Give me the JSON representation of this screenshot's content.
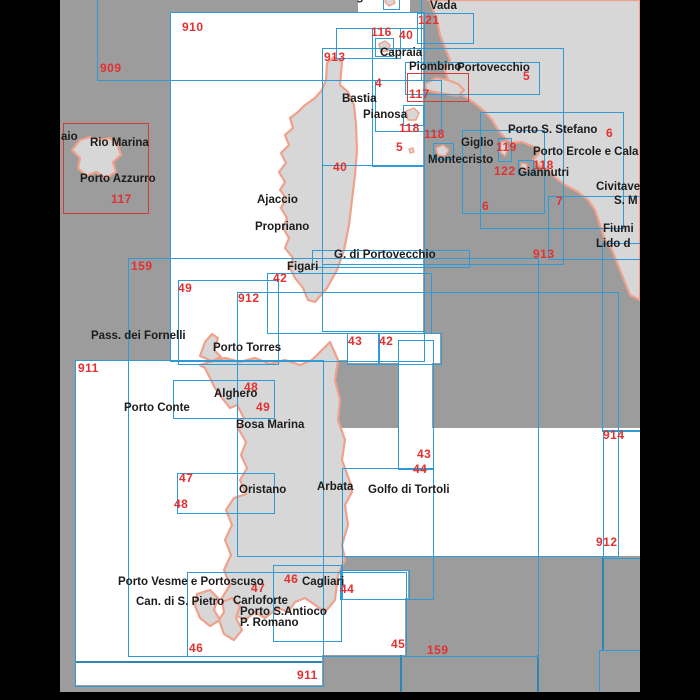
{
  "title": "Chart index map - Corsica, Sardinia and Tuscan Archipelago",
  "colors": {
    "sea": "#9c9c9c",
    "chart_fill": "#ffffff",
    "chart_outline_blue": "#2f9bd6",
    "chart_outline_red": "#d23c34",
    "land_fill": "#d7d7d7",
    "coastline": "#f0a18c",
    "number_red": "#e33030",
    "placename_black": "#1c1c1c",
    "frame_black": "#000000"
  },
  "map": {
    "sea": {
      "x": 60,
      "y": 0,
      "w": 580,
      "h": 692
    },
    "bars": [
      {
        "id": "left-frame-bar",
        "x": 0,
        "y": 0,
        "w": 60,
        "h": 700
      },
      {
        "id": "right-frame-bar",
        "x": 640,
        "y": 0,
        "w": 60,
        "h": 700
      },
      {
        "id": "bottom-frame-bar",
        "x": 60,
        "y": 692,
        "w": 580,
        "h": 8
      }
    ],
    "white_boxes": [
      {
        "id": "chart-area-910",
        "x": 170,
        "y": 12,
        "w": 253,
        "h": 348
      },
      {
        "id": "chart-area-911",
        "x": 75,
        "y": 360,
        "w": 247,
        "h": 325
      },
      {
        "id": "chart-area-top-strip",
        "x": 358,
        "y": 0,
        "w": 52,
        "h": 14
      },
      {
        "id": "chart-area-46-carloforte",
        "x": 187,
        "y": 572,
        "w": 218,
        "h": 83
      },
      {
        "id": "chart-area-46-cagliari",
        "x": 273,
        "y": 565,
        "w": 67,
        "h": 75
      },
      {
        "id": "chart-area-44-cagliari",
        "x": 340,
        "y": 570,
        "w": 68,
        "h": 28
      },
      {
        "id": "chart-area-912-east",
        "x": 342,
        "y": 428,
        "w": 298,
        "h": 128
      },
      {
        "id": "chart-area-bonifacio",
        "x": 347,
        "y": 333,
        "w": 93,
        "h": 30
      },
      {
        "id": "chart-area-east-notch",
        "x": 398,
        "y": 363,
        "w": 34,
        "h": 65
      }
    ],
    "patches": [
      {
        "id": "sea-gap-portovecchio",
        "x": 423,
        "y": 266,
        "w": 39,
        "h": 26
      },
      {
        "id": "sea-gap-south-sardinia",
        "x": 322,
        "y": 555,
        "w": 18,
        "h": 14
      }
    ],
    "outline_boxes": [
      {
        "id": "chart-909",
        "x": 97,
        "y": -10,
        "w": 323,
        "h": 89
      },
      {
        "id": "chart-910",
        "x": 170,
        "y": 12,
        "w": 253,
        "h": 348
      },
      {
        "id": "chart-121",
        "x": 417,
        "y": 13,
        "w": 55,
        "h": 29
      },
      {
        "id": "chart-gorgona",
        "x": 383,
        "y": -6,
        "w": 15,
        "h": 14
      },
      {
        "id": "chart-116",
        "x": 336,
        "y": 28,
        "w": 63,
        "h": 29
      },
      {
        "id": "chart-40-north",
        "x": 372,
        "y": 28,
        "w": 51,
        "h": 137
      },
      {
        "id": "chart-capraia",
        "x": 375,
        "y": 38,
        "w": 17,
        "h": 17
      },
      {
        "id": "chart-4",
        "x": 375,
        "y": 80,
        "w": 65,
        "h": 50
      },
      {
        "id": "chart-piombino-portovecchio",
        "x": 405,
        "y": 62,
        "w": 133,
        "h": 31
      },
      {
        "id": "chart-pianosa",
        "x": 403,
        "y": 105,
        "w": 19,
        "h": 19
      },
      {
        "id": "chart-913",
        "x": 322,
        "y": 48,
        "w": 240,
        "h": 215
      },
      {
        "id": "chart-montecristo",
        "x": 433,
        "y": 143,
        "w": 19,
        "h": 15
      },
      {
        "id": "chart-40-south",
        "x": 322,
        "y": 165,
        "w": 101,
        "h": 165
      },
      {
        "id": "chart-g-di-portovecchio",
        "x": 312,
        "y": 250,
        "w": 156,
        "h": 16
      },
      {
        "id": "chart-42-figari",
        "x": 267,
        "y": 273,
        "w": 163,
        "h": 59
      },
      {
        "id": "chart-159",
        "x": 128,
        "y": 258,
        "w": 409,
        "h": 397
      },
      {
        "id": "chart-49",
        "x": 178,
        "y": 280,
        "w": 99,
        "h": 83
      },
      {
        "id": "chart-912",
        "x": 237,
        "y": 292,
        "w": 380,
        "h": 263
      },
      {
        "id": "chart-43-bonifacio",
        "x": 347,
        "y": 333,
        "w": 31,
        "h": 30
      },
      {
        "id": "chart-42-bonifacio",
        "x": 378,
        "y": 333,
        "w": 62,
        "h": 30
      },
      {
        "id": "chart-911",
        "x": 75,
        "y": 360,
        "w": 247,
        "h": 325
      },
      {
        "id": "chart-48-alghero",
        "x": 173,
        "y": 380,
        "w": 100,
        "h": 37
      },
      {
        "id": "chart-47-48-oristano",
        "x": 177,
        "y": 473,
        "w": 96,
        "h": 39
      },
      {
        "id": "chart-43-east",
        "x": 398,
        "y": 340,
        "w": 34,
        "h": 128
      },
      {
        "id": "chart-44-east",
        "x": 342,
        "y": 468,
        "w": 90,
        "h": 130
      },
      {
        "id": "chart-46-carloforte",
        "x": 187,
        "y": 572,
        "w": 218,
        "h": 83
      },
      {
        "id": "chart-46-cagliari",
        "x": 273,
        "y": 565,
        "w": 67,
        "h": 75
      },
      {
        "id": "chart-44-cagliari",
        "x": 340,
        "y": 570,
        "w": 68,
        "h": 28
      },
      {
        "id": "chart-6-argentario",
        "x": 480,
        "y": 112,
        "w": 142,
        "h": 115
      },
      {
        "id": "chart-119-giglio",
        "x": 498,
        "y": 138,
        "w": 12,
        "h": 22
      },
      {
        "id": "chart-122",
        "x": 462,
        "y": 130,
        "w": 81,
        "h": 82
      },
      {
        "id": "chart-118-giannutri",
        "x": 518,
        "y": 160,
        "w": 14,
        "h": 13
      },
      {
        "id": "chart-7",
        "x": 548,
        "y": 196,
        "w": 92,
        "h": 62
      },
      {
        "id": "chart-fiumicino",
        "x": 602,
        "y": 243,
        "w": 38,
        "h": 187
      },
      {
        "id": "chart-914",
        "x": 603,
        "y": 430,
        "w": 37,
        "h": 127
      },
      {
        "id": "chart-bottom-right",
        "x": 599,
        "y": 650,
        "w": 41,
        "h": 42
      }
    ],
    "red_boxes": [
      {
        "id": "chart-117-elba",
        "x": 63,
        "y": 123,
        "w": 84,
        "h": 89
      },
      {
        "id": "chart-117-piombino",
        "x": 407,
        "y": 73,
        "w": 60,
        "h": 27
      }
    ],
    "segments": [
      {
        "id": "grid-line-v1",
        "x": 400,
        "y": 655,
        "w": 2,
        "h": 37
      },
      {
        "id": "grid-line-v2",
        "x": 537,
        "y": 655,
        "w": 2,
        "h": 37
      },
      {
        "id": "grid-line-v3",
        "x": 602,
        "y": 557,
        "w": 2,
        "h": 93
      },
      {
        "id": "grid-line-h1",
        "x": 75,
        "y": 661,
        "w": 247,
        "h": 2
      }
    ],
    "land": [
      {
        "id": "corsica",
        "d": "M334,57 L342,62 L340,85 L348,92 L354,105 L356,125 L357,150 L355,175 L352,200 L349,225 L344,250 L337,270 L327,288 L315,302 L308,300 L303,288 L295,278 L290,268 L293,258 L285,248 L289,238 L283,228 L287,218 L281,208 L286,198 L280,190 L285,182 L279,172 L286,163 L281,153 L289,145 L285,135 L293,128 L290,118 L298,112 L305,105 L315,98 L322,90 L326,80 L327,63 Z"
      },
      {
        "id": "sardinia",
        "d": "M330,342 L338,360 L335,380 L340,400 L338,420 L345,440 L342,460 L350,482 L352,492 L345,505 L348,525 L342,545 L345,560 L338,575 L335,600 L325,612 L315,605 L305,598 L295,602 L288,612 L278,608 L265,618 L255,612 L245,620 L235,615 L228,622 L222,598 L230,585 L224,570 L231,555 L225,540 L232,525 L226,510 L234,498 L246,494 L240,480 L247,468 L241,455 L246,442 L239,430 L244,418 L237,405 L230,408 L222,398 L215,388 L210,378 L205,368 L200,365 L210,362 L225,358 L240,362 L255,358 L270,364 L285,360 L300,365 L312,360 L322,350 Z"
      },
      {
        "id": "italian-mainland",
        "d": "M428,0 L640,0 L640,300 L630,295 L620,270 L612,250 L605,240 L600,225 L595,210 L588,200 L578,192 L565,185 L556,178 L548,170 L540,166 L533,160 L540,152 L532,146 L522,142 L512,143 L505,138 L498,130 L492,120 L485,112 L478,106 L470,100 L462,95 L455,88 L448,80 L445,70 L450,60 L445,48 L440,35 L437,20 L433,10 L430,0 Z"
      },
      {
        "id": "piombino-promontory",
        "d": "M425,84 L436,78 L448,80 L458,84 L464,90 L458,96 L446,94 L434,92 L426,90 Z"
      },
      {
        "id": "elba",
        "d": "M72,150 L80,140 L90,137 L100,140 L110,138 L118,146 L121,155 L113,162 L116,172 L106,178 L96,172 L86,176 L78,168 L80,158 Z"
      },
      {
        "id": "asinara",
        "d": "M200,356 L205,342 L212,334 L218,338 L214,350 L221,357 L212,361 Z"
      },
      {
        "id": "san-pietro",
        "d": "M197,594 L210,590 L218,598 L214,610 L220,620 L210,626 L200,618 L195,606 Z"
      },
      {
        "id": "sant-antioco",
        "d": "M222,602 L232,598 L240,606 L236,618 L242,630 L234,640 L224,634 L219,620 L224,612 Z"
      }
    ],
    "islets": [
      {
        "id": "capraia-islet",
        "d": "M379,44 L385,41 L390,45 L388,51 L381,52 Z"
      },
      {
        "id": "gorgona-islet",
        "d": "M386,-2 L393,-3 L395,3 L389,6 L385,2 Z"
      },
      {
        "id": "pianosa-islet",
        "d": "M406,111 L414,108 L419,113 L416,120 L408,120 Z"
      },
      {
        "id": "montecristo-islet",
        "d": "M436,148 L443,145 L449,150 L445,156 L438,155 Z"
      },
      {
        "id": "giglio-islet",
        "d": "M501,142 L506,141 L508,149 L505,156 L500,152 Z"
      },
      {
        "id": "giannutri-islet",
        "d": "M521,163 L527,164 L526,171 L521,169 Z"
      },
      {
        "id": "scoglio-islet",
        "d": "M409,149 L413,148 L414,152 L410,153 Z"
      }
    ],
    "labels_red": [
      {
        "text": "909",
        "x": 100,
        "y": 62
      },
      {
        "text": "910",
        "x": 182,
        "y": 21
      },
      {
        "text": "913",
        "x": 324,
        "y": 51
      },
      {
        "text": "116",
        "x": 371,
        "y": 26
      },
      {
        "text": "40",
        "x": 399,
        "y": 29
      },
      {
        "text": "121",
        "x": 418,
        "y": 14
      },
      {
        "text": "4",
        "x": 375,
        "y": 77
      },
      {
        "text": "117",
        "x": 409,
        "y": 88
      },
      {
        "text": "118",
        "x": 399,
        "y": 122
      },
      {
        "text": "5",
        "x": 396,
        "y": 141
      },
      {
        "text": "118",
        "x": 424,
        "y": 128
      },
      {
        "text": "5",
        "x": 523,
        "y": 70
      },
      {
        "text": "119",
        "x": 496,
        "y": 141
      },
      {
        "text": "118",
        "x": 533,
        "y": 159
      },
      {
        "text": "122",
        "x": 494,
        "y": 165
      },
      {
        "text": "6",
        "x": 606,
        "y": 127
      },
      {
        "text": "6",
        "x": 482,
        "y": 200
      },
      {
        "text": "7",
        "x": 556,
        "y": 195
      },
      {
        "text": "913",
        "x": 533,
        "y": 248
      },
      {
        "text": "117",
        "x": 111,
        "y": 193
      },
      {
        "text": "159",
        "x": 131,
        "y": 260
      },
      {
        "text": "49",
        "x": 178,
        "y": 282
      },
      {
        "text": "42",
        "x": 273,
        "y": 272
      },
      {
        "text": "912",
        "x": 238,
        "y": 292
      },
      {
        "text": "40",
        "x": 333,
        "y": 161
      },
      {
        "text": "43",
        "x": 348,
        "y": 335
      },
      {
        "text": "42",
        "x": 379,
        "y": 335
      },
      {
        "text": "911",
        "x": 78,
        "y": 362
      },
      {
        "text": "48",
        "x": 244,
        "y": 381
      },
      {
        "text": "49",
        "x": 256,
        "y": 401
      },
      {
        "text": "914",
        "x": 603,
        "y": 429
      },
      {
        "text": "43",
        "x": 417,
        "y": 448
      },
      {
        "text": "44",
        "x": 413,
        "y": 463
      },
      {
        "text": "47",
        "x": 179,
        "y": 472
      },
      {
        "text": "48",
        "x": 174,
        "y": 498
      },
      {
        "text": "912",
        "x": 596,
        "y": 536
      },
      {
        "text": "46",
        "x": 284,
        "y": 573
      },
      {
        "text": "47",
        "x": 251,
        "y": 582
      },
      {
        "text": "44",
        "x": 340,
        "y": 583
      },
      {
        "text": "46",
        "x": 189,
        "y": 642
      },
      {
        "text": "45",
        "x": 391,
        "y": 638
      },
      {
        "text": "159",
        "x": 427,
        "y": 644
      },
      {
        "text": "911",
        "x": 297,
        "y": 669
      }
    ],
    "labels_place": [
      {
        "text": "Gorgona",
        "x": 336,
        "y": -8
      },
      {
        "text": "Vada",
        "x": 430,
        "y": 1
      },
      {
        "text": "Capraia",
        "x": 380,
        "y": 48
      },
      {
        "text": "Piombino",
        "x": 409,
        "y": 62
      },
      {
        "text": "Portovecchio",
        "x": 457,
        "y": 63
      },
      {
        "text": "Bastia",
        "x": 342,
        "y": 94
      },
      {
        "text": "Pianosa",
        "x": 363,
        "y": 110
      },
      {
        "text": "aio",
        "x": 61,
        "y": 132
      },
      {
        "text": "Rio Marina",
        "x": 90,
        "y": 138
      },
      {
        "text": "Porto Azzurro",
        "x": 80,
        "y": 174
      },
      {
        "text": "Porto S. Stefano",
        "x": 508,
        "y": 125
      },
      {
        "text": "Giglio",
        "x": 461,
        "y": 138
      },
      {
        "text": "Porto Ercole e Cala G",
        "x": 533,
        "y": 147
      },
      {
        "text": "Montecristo",
        "x": 428,
        "y": 155
      },
      {
        "text": "Giannutri",
        "x": 518,
        "y": 168
      },
      {
        "text": "Civitave",
        "x": 596,
        "y": 182
      },
      {
        "text": "S. M",
        "x": 614,
        "y": 196
      },
      {
        "text": "Fiumi",
        "x": 603,
        "y": 224
      },
      {
        "text": "Lido d",
        "x": 596,
        "y": 239
      },
      {
        "text": "Ajaccio",
        "x": 257,
        "y": 195
      },
      {
        "text": "Propriano",
        "x": 255,
        "y": 222
      },
      {
        "text": "G. di Portovecchio",
        "x": 334,
        "y": 250
      },
      {
        "text": "Figari",
        "x": 287,
        "y": 262
      },
      {
        "text": "Pass. dei Fornelli",
        "x": 91,
        "y": 331
      },
      {
        "text": "Porto Torres",
        "x": 213,
        "y": 343
      },
      {
        "text": "Alghero",
        "x": 214,
        "y": 389
      },
      {
        "text": "Porto Conte",
        "x": 124,
        "y": 403
      },
      {
        "text": "Bosa Marina",
        "x": 236,
        "y": 420
      },
      {
        "text": "Oristano",
        "x": 239,
        "y": 485
      },
      {
        "text": "Arbata",
        "x": 317,
        "y": 482
      },
      {
        "text": "Golfo di Tortoli",
        "x": 368,
        "y": 485
      },
      {
        "text": "Porto Vesme e Portoscuso",
        "x": 118,
        "y": 577
      },
      {
        "text": "Cagliari",
        "x": 302,
        "y": 577
      },
      {
        "text": "Can. di S. Pietro",
        "x": 136,
        "y": 597
      },
      {
        "text": "Carloforte",
        "x": 233,
        "y": 596
      },
      {
        "text": "Porto S.Antioco",
        "x": 240,
        "y": 607
      },
      {
        "text": "P. Romano",
        "x": 240,
        "y": 618
      }
    ]
  }
}
